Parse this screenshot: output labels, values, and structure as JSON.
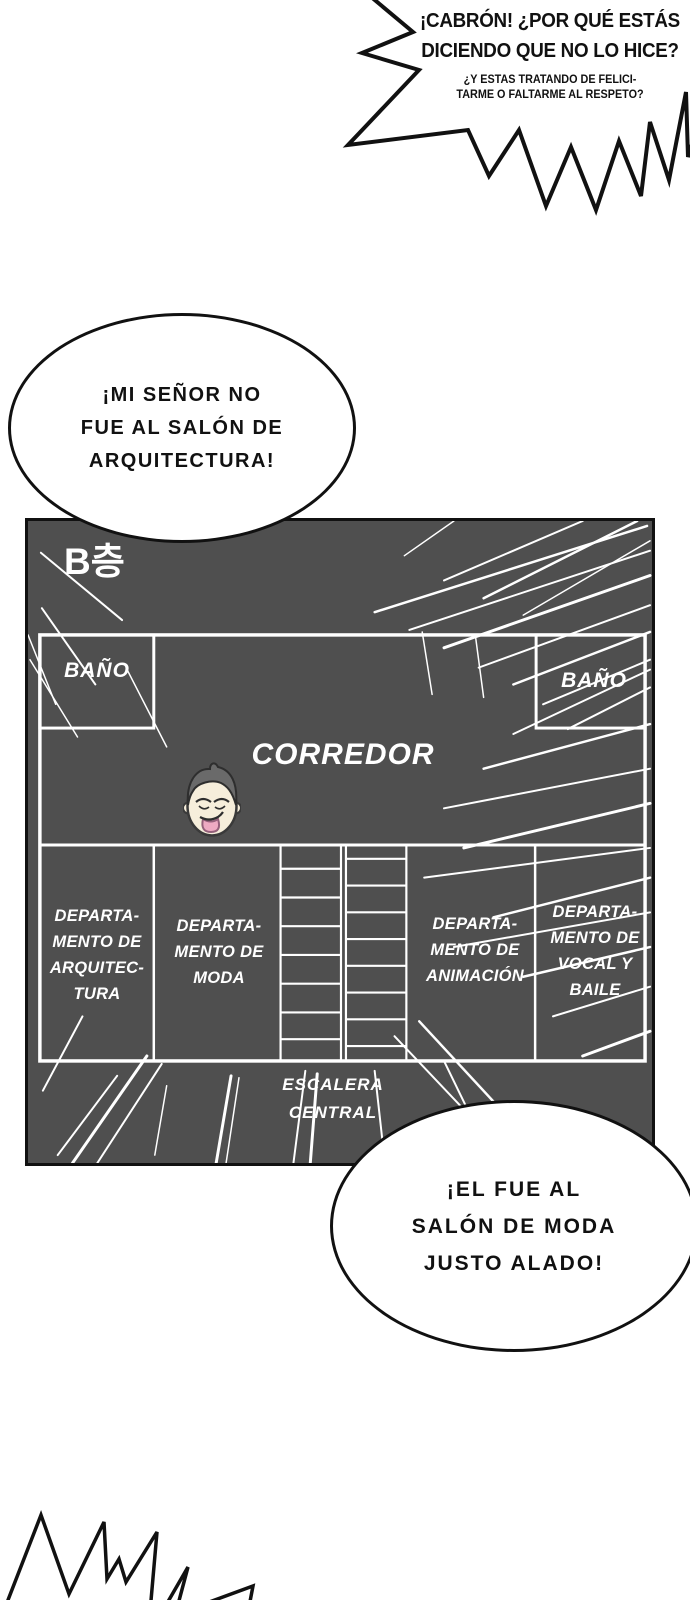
{
  "colors": {
    "page_bg": "#ffffff",
    "panel_bg": "#4f4f4f",
    "wall_line": "#ffffff",
    "ink": "#111111",
    "skin": "#f6eedb",
    "hair": "#6a6a6a",
    "tongue": "#eeaac2"
  },
  "bubbles": {
    "shout_top": {
      "line1": "¡CABRÓN! ¿POR QUÉ ESTÁS",
      "line2": "DICIENDO QUE NO LO HICE?",
      "small1": "¿Y ESTAS TRATANDO DE FELICI-",
      "small2": "TARME O FALTARME AL RESPETO?"
    },
    "oval_my_lord": {
      "line1": "¡MI SEÑOR NO",
      "line2": "FUE AL SALÓN DE",
      "line3": "ARQUITECTURA!"
    },
    "oval_he_went": {
      "line1": "¡EL FUE AL",
      "line2": "SALÓN DE MODA",
      "line3": "JUSTO ALADO!"
    }
  },
  "floorplan": {
    "floor_label": "B층",
    "bathroom_left": "BAÑO",
    "bathroom_right": "BAÑO",
    "corridor": "CORREDOR",
    "stairs_line1": "ESCALERA",
    "stairs_line2": "CENTRAL",
    "dept_architecture": {
      "l1": "DEPARTA-",
      "l2": "MENTO DE",
      "l3": "ARQUITEC-",
      "l4": "TURA"
    },
    "dept_fashion": {
      "l1": "DEPARTA-",
      "l2": "MENTO DE",
      "l3": "MODA"
    },
    "dept_animation": {
      "l1": "DEPARTA-",
      "l2": "MENTO DE",
      "l3": "ANIMACIÓN"
    },
    "dept_vocal": {
      "l1": "DEPARTA-",
      "l2": "MENTO DE",
      "l3": "VOCAL Y",
      "l4": "BAILE"
    }
  }
}
